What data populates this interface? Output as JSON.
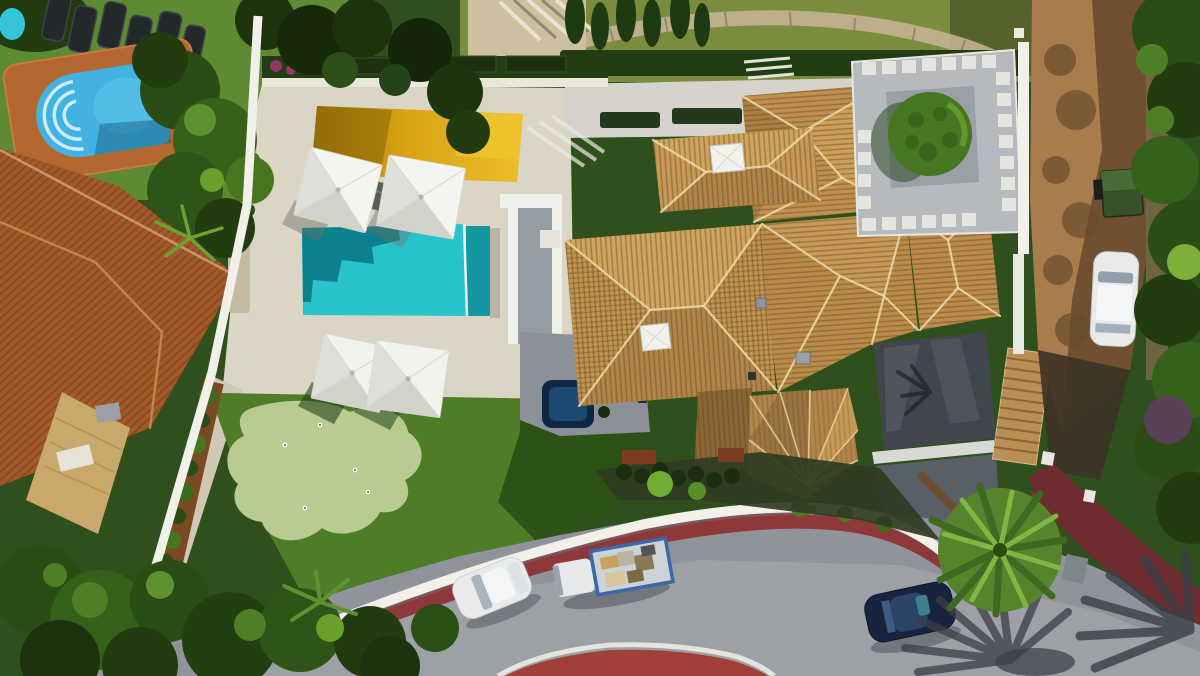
{
  "meta": {
    "title": "Aerial drone view of a modern Mediterranean villa with pool",
    "description": "Top-down aerial photo: walled villa plot with turquoise pool and spa, golden sun deck, four white square parasols, sun loungers, artificial lawn with putting green, hot tub, villa with tan terracotta hip roofs and skylights, gravel courtyard with clipped round tree, neighbor garden with blue roman-step pool and terracotta roof, dirt side road with parked white car and green waste container, curved street with white boundary wall, red pedestrian path, parked white hatchback, loaded flatbed truck, dark blue car, palm trees and long palm shadows.",
    "image_width": 1200,
    "image_height": 676
  },
  "scene": {
    "setting": "sunny residential neighborhood, top-down drone view, shadows cast to lower-left",
    "objects": [
      {
        "name": "neighbor-lawn",
        "label": "Neighbor lawn with six dark sun loungers"
      },
      {
        "name": "neighbor-pool",
        "label": "Blue pool with roman arch steps and terracotta deck"
      },
      {
        "name": "neighbor-roof",
        "label": "Neighbor terracotta tiled hip roof"
      },
      {
        "name": "boundary-wall-left",
        "label": "White boundary wall along the left side"
      },
      {
        "name": "gold-sun-deck",
        "label": "Golden reflective sun deck"
      },
      {
        "name": "parasols",
        "label": "Four white square parasols with loungers"
      },
      {
        "name": "main-pool",
        "label": "Turquoise rectangular pool with spa edge"
      },
      {
        "name": "terrace",
        "label": "Cream stone pool terrace"
      },
      {
        "name": "lawn",
        "label": "Green lawn"
      },
      {
        "name": "putting-green",
        "label": "Light green mini-golf putting green with flags"
      },
      {
        "name": "hot-tub",
        "label": "Square navy hot tub"
      },
      {
        "name": "villa-roofs",
        "label": "Villa with tan terracotta hip roofs and skylights"
      },
      {
        "name": "charcoal-flat-roof",
        "label": "Dark flat garage roof"
      },
      {
        "name": "gravel-courtyard",
        "label": "Gray gravel courtyard with white pavers"
      },
      {
        "name": "round-tree",
        "label": "Clipped round green tree"
      },
      {
        "name": "dirt-road",
        "label": "Brown dirt access road on the right"
      },
      {
        "name": "parked-white-suv",
        "label": "White car parked on dirt road"
      },
      {
        "name": "waste-container",
        "label": "Dark green waste container"
      },
      {
        "name": "street",
        "label": "Curved asphalt street at the bottom"
      },
      {
        "name": "street-wall",
        "label": "Curved white street-side wall"
      },
      {
        "name": "red-path",
        "label": "Red pedestrian path along the wall"
      },
      {
        "name": "red-island",
        "label": "Red traffic island at bottom center"
      },
      {
        "name": "white-car",
        "label": "White hatchback parked on street"
      },
      {
        "name": "flatbed-truck",
        "label": "Flatbed truck loaded with material"
      },
      {
        "name": "blue-car",
        "label": "Dark blue car on street"
      },
      {
        "name": "palms",
        "label": "Palm trees and fan-shaped palm shadows"
      },
      {
        "name": "entrance-driveway",
        "label": "Maroon entrance driveway with gate posts"
      }
    ]
  },
  "colors": {
    "terrace": "#dbd5c6",
    "terrace_path": "#cfc8b6",
    "pool_water": "#29c4cb",
    "pool_shadow": "#0c818e",
    "pool_spa": "#1497a1",
    "gold_deck": "#d9a413",
    "gold_bright": "#efc42f",
    "lawn": "#4f7d27",
    "lawn_shadow": "#2d5215",
    "putting_green": "#b9cb90",
    "roof_tile": "#c29552",
    "roof_tile_light": "#cfa55e",
    "roof_tile_dark": "#b0854a",
    "roof_shadowed": "#8a6637",
    "roof_ridge": "#eed9a9",
    "charcoal_roof": "#41464e",
    "gravel": "#b6b9be",
    "paver": "#e8e7e2",
    "white_wall": "#f1f0e9",
    "asphalt": "#90949a",
    "asphalt_light": "#a8acb1",
    "road_shadow": "#3a3f47",
    "dirt_road": "#a87c4c",
    "dirt_shadow": "#5d4228",
    "red_path": "#8f383a",
    "red_island": "#a04038",
    "terracotta_roof": "#a2592a",
    "pool_deck": "#b4672f",
    "neighbor_pool": "#41b2e2",
    "tree_dark": "#2a4c15",
    "tree_mid": "#47761f",
    "tree_light": "#69a02c",
    "palm_green": "#55842d",
    "mulch": "#7a4a22",
    "hot_tub_shell": "#0f2742",
    "hot_tub_water": "#1d4a70",
    "car_white": "#e9eaec",
    "car_dark_blue": "#18243f",
    "truck_bed_border": "#3a68a8",
    "dumpster": "#35502a",
    "round_tree": "#46761f",
    "back_lawn": "#7b8c3e",
    "stone_path": "#c3b291"
  }
}
